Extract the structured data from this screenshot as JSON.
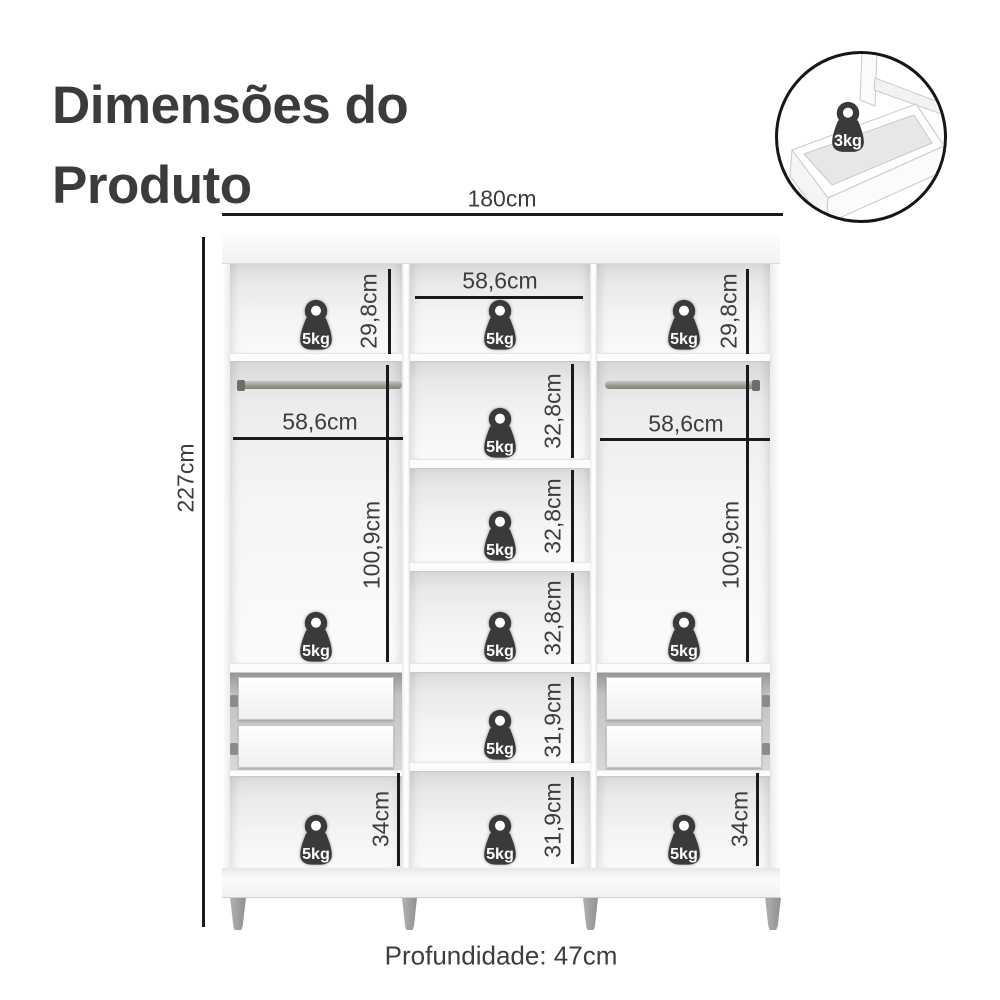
{
  "title": {
    "line1": "Dimensões do",
    "line2": "Produto"
  },
  "inset": {
    "weight_label": "3kg"
  },
  "overall_dimensions": {
    "width": "180cm",
    "height": "227cm",
    "depth": "Profundidade: 47cm"
  },
  "shelf_weight_label": "5kg",
  "internal_dimensions": {
    "top_left_height": "29,8cm",
    "top_middle_width": "58,6cm",
    "top_right_height": "29,8cm",
    "left_rod_width": "58,6cm",
    "right_rod_width": "58,6cm",
    "left_hanging_height": "100,9cm",
    "right_hanging_height": "100,9cm",
    "middle_shelf_1_height": "32,8cm",
    "middle_shelf_2_height": "32,8cm",
    "middle_shelf_3_height": "32,8cm",
    "middle_shelf_4_height": "31,9cm",
    "middle_bottom_height": "31,9cm",
    "bottom_left_height": "34cm",
    "bottom_right_height": "34cm"
  },
  "colors": {
    "weight_fill": "#3a3a3a",
    "dimension_line": "#1a1a1a",
    "label_text": "#3d3d3d",
    "title_text": "#3b3b3b"
  }
}
